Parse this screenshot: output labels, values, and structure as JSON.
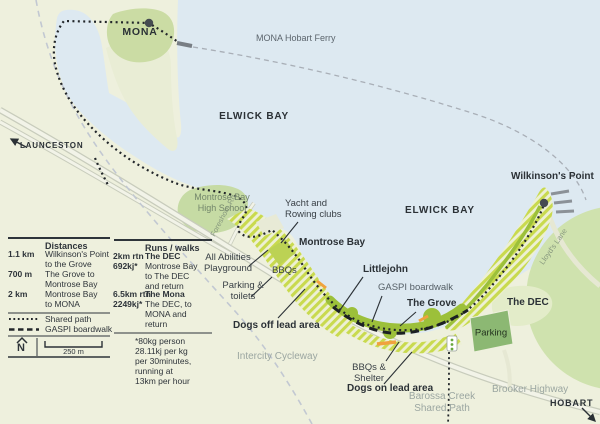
{
  "labels": {
    "mona": "MONA",
    "ferry": "MONA Hobart Ferry",
    "elwick_north": "ELWICK BAY",
    "elwick_east": "ELWICK BAY",
    "launceston": "LAUNCESTON",
    "school": "Montrose Bay\nHigh School",
    "yacht": "Yacht and\nRowing clubs",
    "montrose_bay": "Montrose Bay",
    "wilkinsons": "Wilkinson's Point",
    "foreshore": "Foreshore Rd",
    "lloyds": "Lloyd's Lane",
    "playground": "All Abilities\nPlayground",
    "bbqs": "BBQs",
    "parking_toilets": "Parking &\ntoilets",
    "dogs_off": "Dogs off lead area",
    "littlejohn": "Littlejohn",
    "gaspi": "GASPI boardwalk",
    "grove": "The Grove",
    "dec": "The DEC",
    "parking": "Parking",
    "intercity": "Intercity Cycleway",
    "bbq_shelter": "BBQs &\nShelter",
    "dogs_on": "Dogs on lead area",
    "barossa": "Barossa Creek\nShared Path",
    "brooker": "Brooker Highway",
    "hobart": "HOBART"
  },
  "legend": {
    "distances": {
      "title": "Distances",
      "rows": [
        {
          "value": "1.1 km",
          "label": "Wilkinson's Point\nto the Grove"
        },
        {
          "value": "700 m",
          "label": "The Grove to\nMontrose Bay"
        },
        {
          "value": "2 km",
          "label": "Montrose Bay\nto MONA"
        }
      ]
    },
    "symbols": [
      {
        "label": "Shared path"
      },
      {
        "label": "GASPI boardwalk"
      }
    ],
    "north": "N",
    "scale": "250 m",
    "runs": {
      "title": "Runs / walks",
      "rows": [
        {
          "value": "2km rtn\n692kj*",
          "name": "The DEC",
          "desc": "Montrose Bay\nto The DEC\nand return"
        },
        {
          "value": "6.5km rtn\n2249kj*",
          "name": "The Mona",
          "desc": "The DEC, to\nMONA and\nreturn"
        }
      ],
      "footnote": "*80kg person\n28.11kj per kg\nper 30minutes,\nrunning at\n13km per hour"
    }
  },
  "colors": {
    "water": "#dde9f1",
    "land": "#eef0dd",
    "park_green": "#cbdca4",
    "hatch_stripe": "#c9da4e",
    "shore_green": "#9cc03a",
    "parking_green": "#8cb873",
    "boardwalk_black": "#1c2023",
    "orange_marker": "#f0a23e",
    "grey_label": "#9ba6a1"
  }
}
